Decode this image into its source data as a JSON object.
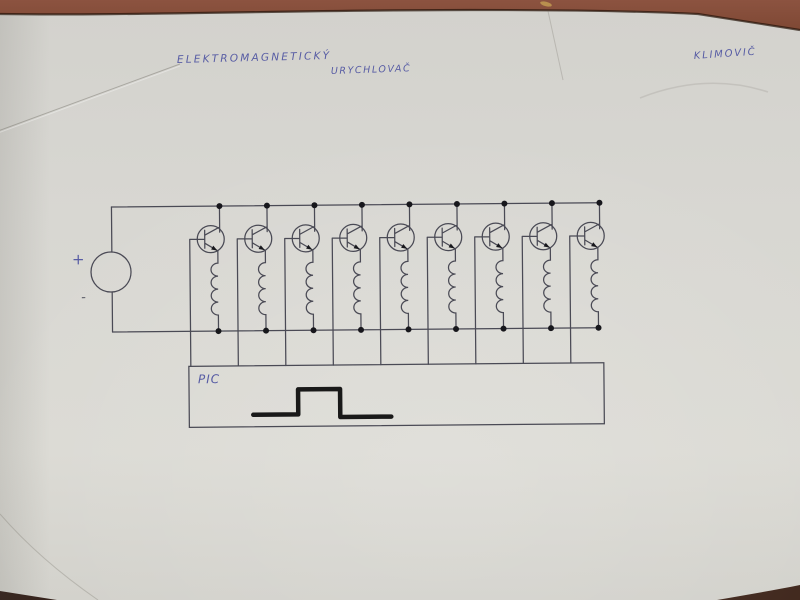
{
  "surface": {
    "table_color": "#7c4a35",
    "paper_color": "#d8d7d2"
  },
  "handwriting": {
    "title_line1": "ELEKTROMAGNETICKÝ",
    "title_line2": "URYCHLOVAČ",
    "signature": "KLIMOVIČ",
    "ink_color": "#575ca4"
  },
  "diagram": {
    "type": "hand-drawn schematic: electromagnetic accelerator (coilgun) driver",
    "power_source": {
      "symbol": "circle",
      "plus_label": "+",
      "minus_label": "-"
    },
    "stages": {
      "count": 9,
      "description": "NPN transistor with collector on top supply rail, emitter through a coil to bottom rail, base wired down into PIC controller box"
    },
    "controller": {
      "label": "PIC",
      "waveform": "single rectangular pulse"
    }
  }
}
